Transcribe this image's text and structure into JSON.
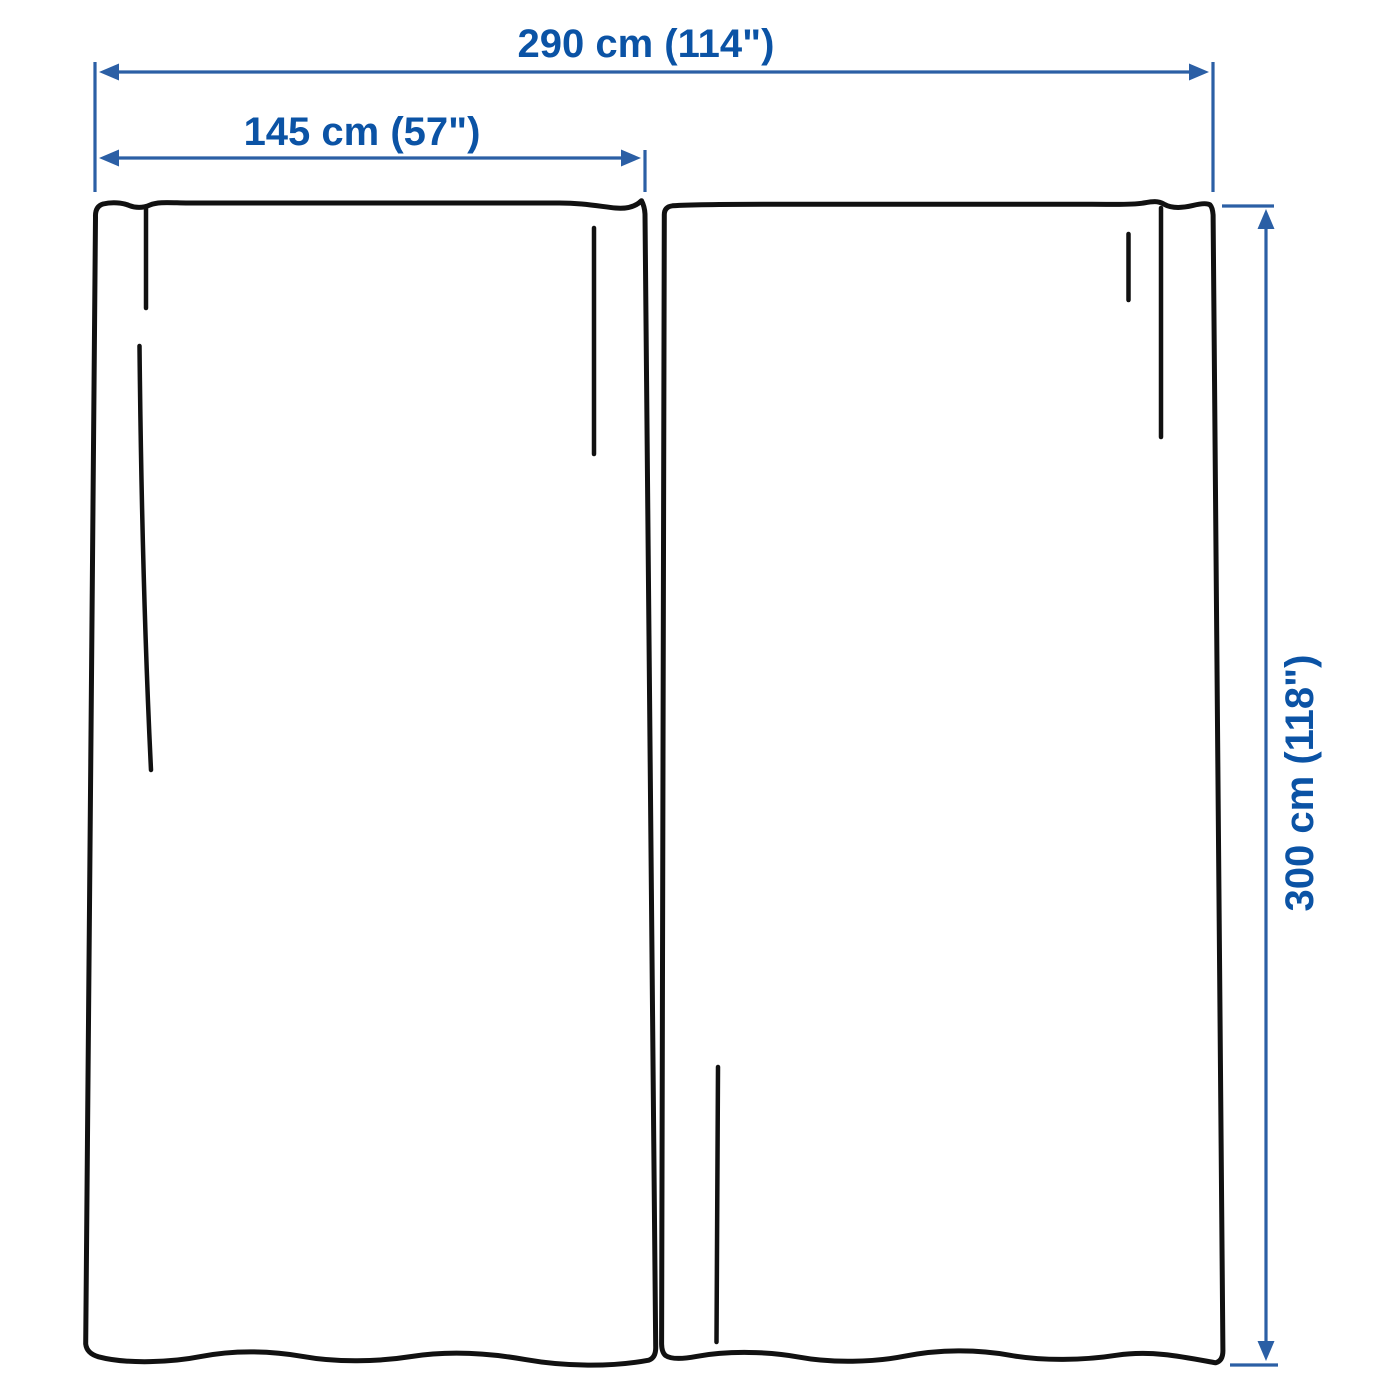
{
  "dimensions": {
    "total_width_label": "290 cm (114\")",
    "panel_width_label": "145 cm (57\")",
    "panel_height_label": "300 cm (118\")"
  },
  "panel_count": 2,
  "colors": {
    "dimension_text": "#0B53A5",
    "dimension_line": "#2B5FA5",
    "outline": "#111111",
    "background": "#FFFFFF"
  }
}
